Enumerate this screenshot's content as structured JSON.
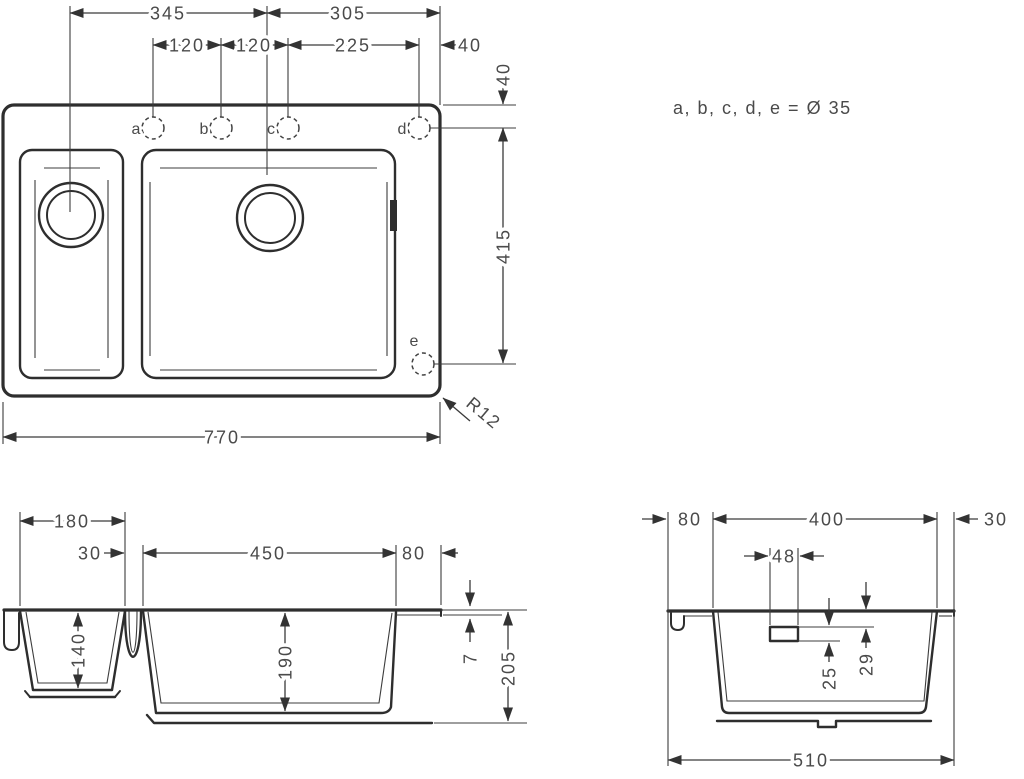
{
  "colors": {
    "line": "#2e2e2e",
    "dim_line": "#3a3a3a",
    "text": "#4a4a4a",
    "background": "#ffffff"
  },
  "note": {
    "text": "a, b, c, d, e = Ø 35"
  },
  "plan": {
    "d345": "345",
    "d305": "305",
    "d120a": "120",
    "d120b": "120",
    "d225": "225",
    "d40h": "40",
    "d40v": "40",
    "d415": "415",
    "d770": "770",
    "r12": "R12",
    "hole_a": "a",
    "hole_b": "b",
    "hole_c": "c",
    "hole_d": "d",
    "hole_e": "e"
  },
  "front": {
    "d180": "180",
    "d30": "30",
    "d450": "450",
    "d80": "80",
    "d140": "140",
    "d190": "190",
    "d7": "7",
    "d205": "205"
  },
  "side": {
    "d80": "80",
    "d400": "400",
    "d30": "30",
    "d48": "48",
    "d25": "25",
    "d29": "29",
    "d510": "510"
  }
}
